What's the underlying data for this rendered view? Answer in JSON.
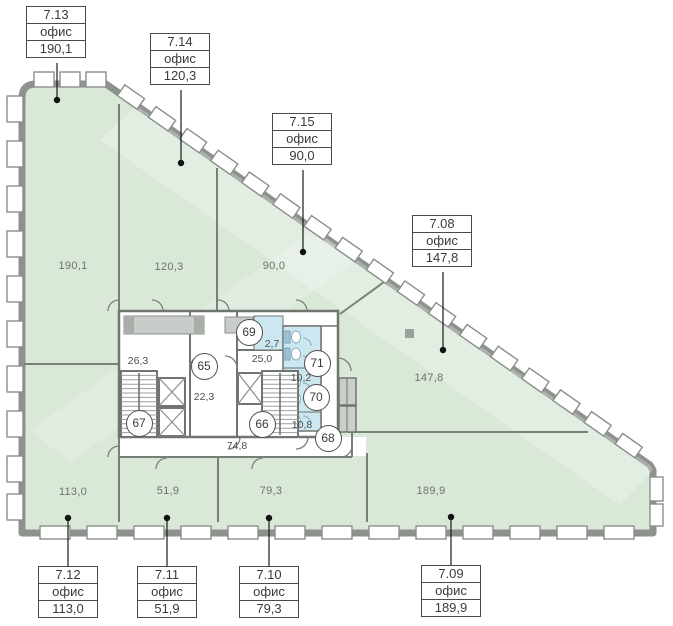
{
  "callouts": [
    {
      "number": "7.13",
      "type": "офис",
      "area": "190,1"
    },
    {
      "number": "7.14",
      "type": "офис",
      "area": "120,3"
    },
    {
      "number": "7.15",
      "type": "офис",
      "area": "90,0"
    },
    {
      "number": "7.08",
      "type": "офис",
      "area": "147,8"
    },
    {
      "number": "7.12",
      "type": "офис",
      "area": "113,0"
    },
    {
      "number": "7.11",
      "type": "офис",
      "area": "51,9"
    },
    {
      "number": "7.10",
      "type": "офис",
      "area": "79,3"
    },
    {
      "number": "7.09",
      "type": "офис",
      "area": "189,9"
    }
  ],
  "room_labels": [
    "190,1",
    "120,3",
    "90,0",
    "147,8",
    "113,0",
    "51,9",
    "79,3",
    "189,9"
  ],
  "core": {
    "left_stair_lobby": "26,3",
    "corridor": "22,3",
    "right_stair_lobby": "25,0",
    "small_room": "2,7",
    "wc_upper": "10,2",
    "wc_lower": "10,8",
    "hallway": "74,8"
  },
  "nodes": [
    "65",
    "66",
    "67",
    "68",
    "69",
    "70",
    "71"
  ],
  "colors": {
    "office_fill": "#d9e8d7",
    "wet_zone_fill": "#cde7f1",
    "wall": "#8d928d",
    "vestibule": "#c9cdc9"
  }
}
